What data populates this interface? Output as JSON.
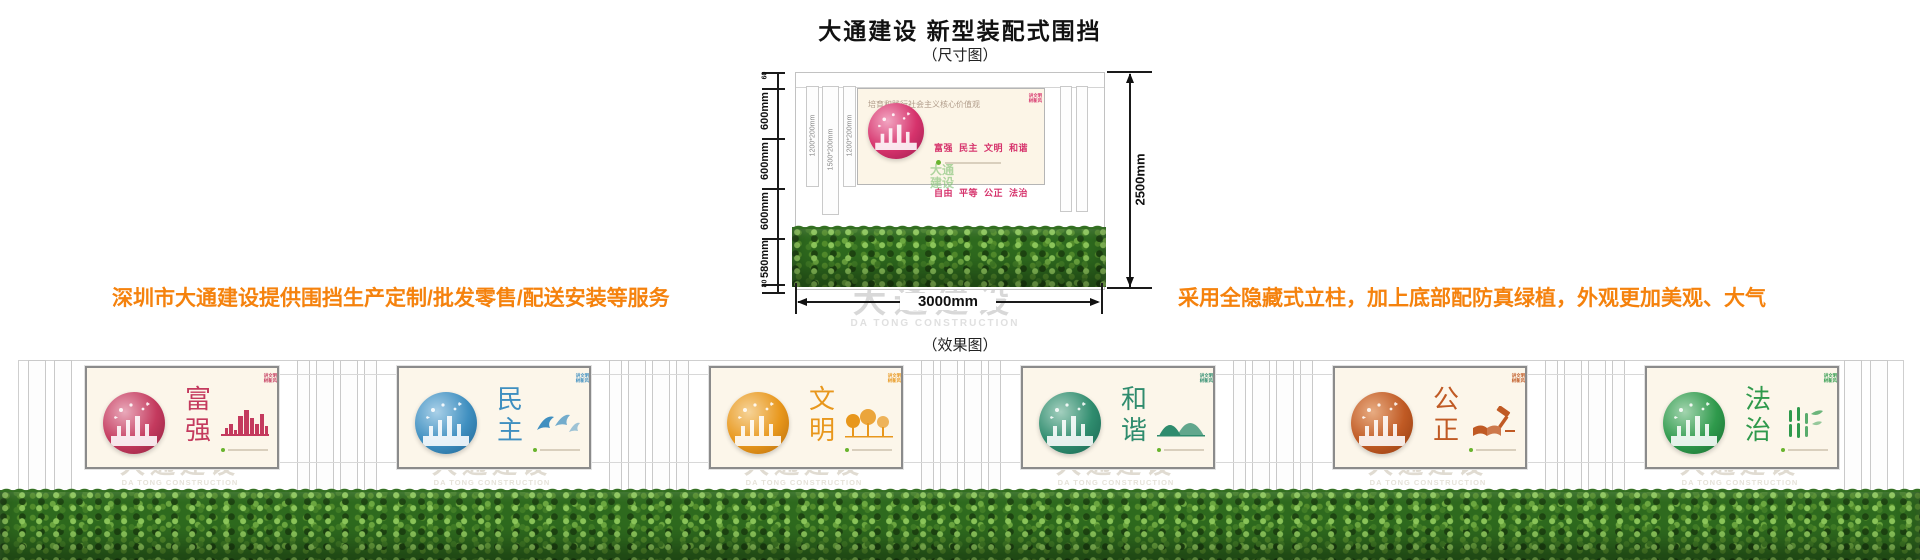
{
  "header": {
    "title": "大通建设 新型装配式围挡",
    "subtitle": "（尺寸图）",
    "effect_label": "（效果图）"
  },
  "marketing": {
    "left": "深圳市大通建设提供围挡生产定制/批发零售/配送安装等服务",
    "right": "采用全隐藏式立柱，加上底部配防真绿植，外观更加美观、大气",
    "color": "#F5820D"
  },
  "dimension_diagram": {
    "left_dims": [
      "60",
      "600mm",
      "600mm",
      "600mm",
      "580mm",
      "80"
    ],
    "right_dim": "2500mm",
    "bottom_dim": "3000mm",
    "post_labels": [
      "1200*200mm",
      "1500*200mm",
      "1200*200mm"
    ],
    "board": {
      "header": "培育和践行社会主义核心价值观",
      "badge_line1": "讲文明",
      "badge_line2": "树新风",
      "rows": [
        "富强  民主  文明  和谐",
        "自由  平等  公正  法治",
        "爱国  敬业  诚信  友善"
      ],
      "accent": "#D6336C",
      "light": "#F2A6C2",
      "dark": "#9C1B4E"
    },
    "logo_watermark": {
      "line1": "大通",
      "line2": "建设"
    }
  },
  "watermark": {
    "cn": "大通建设",
    "en": "DA TONG CONSTRUCTION"
  },
  "effect_panels": {
    "common": {
      "header": "培育和践行社会主义核心价值观",
      "tagline": "富强 民主 文明 和谐 自由 平等 公正 法治 爱国 敬业 诚信 友善",
      "badge_line1": "讲文明",
      "badge_line2": "树新风"
    },
    "items": [
      {
        "word": "富强",
        "accent": "#C43A5E",
        "light": "#E9A9BA",
        "dark": "#8E1F3E",
        "motif": "skyline"
      },
      {
        "word": "民主",
        "accent": "#3F8FC0",
        "light": "#A9D0E8",
        "dark": "#1F6391",
        "motif": "doves"
      },
      {
        "word": "文明",
        "accent": "#E8971C",
        "light": "#F6D398",
        "dark": "#B56A0A",
        "motif": "trees"
      },
      {
        "word": "和谐",
        "accent": "#2F8C6E",
        "light": "#A3CFBE",
        "dark": "#176350",
        "motif": "mountains"
      },
      {
        "word": "公正",
        "accent": "#C05A24",
        "light": "#E8AC82",
        "dark": "#8F3A0F",
        "motif": "justice"
      },
      {
        "word": "法治",
        "accent": "#2F9A4C",
        "light": "#A2D4AE",
        "dark": "#176B30",
        "motif": "bamboo"
      }
    ]
  }
}
